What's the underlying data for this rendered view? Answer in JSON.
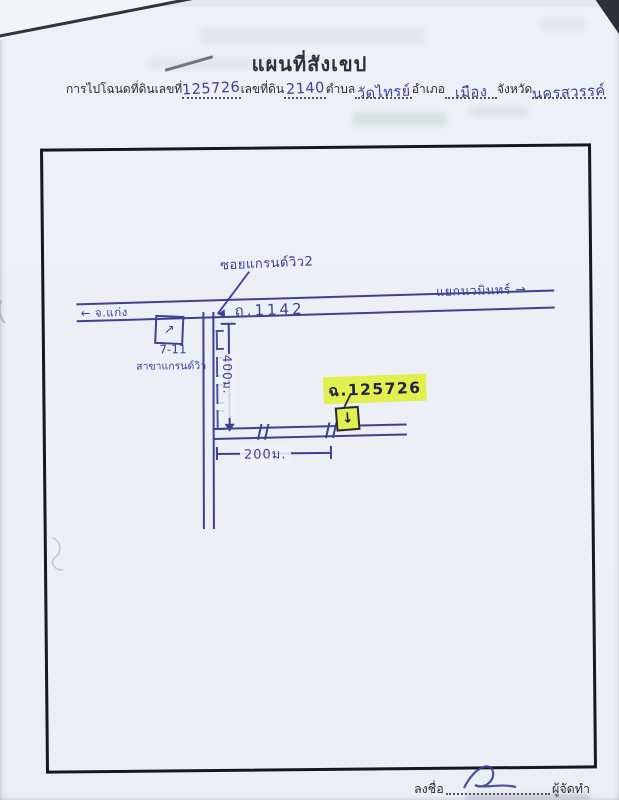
{
  "header": {
    "title": "แผนที่สังเขป",
    "form": {
      "deed_label": "การไปโฉนดที่ดินเลขที่",
      "deed_value": "125726",
      "parcel_label": "เลขที่ดิน",
      "parcel_value": "2140",
      "tambon_label": "ตำบล",
      "tambon_value": "วัดไทรย์",
      "amphoe_label": "อำเภอ",
      "amphoe_value": "เมือง",
      "province_label": "จังหวัด",
      "province_value": "นครสวรรค์"
    }
  },
  "map": {
    "main_road_label": "ถ.1142",
    "left_direction": "จ.แก่ง",
    "left_arrow": "←",
    "right_direction": "แยกนวมินทร์",
    "right_arrow": "→",
    "soi_label": "ซอยแกรนด์วิว2",
    "store_name": "7-11",
    "store_branch": "สาขาแกรนด์วิว",
    "store_arrow": "↗",
    "vertical_distance": "400ม.",
    "horizontal_distance": "200ม.",
    "parcel_tag": "ฉ.125726",
    "parcel_arrow": "↓"
  },
  "footer": {
    "sign_label": "ลงชื่อ",
    "maker_label": "ผู้จัดทำ"
  },
  "colors": {
    "pen_blue": "#3c4196",
    "ink_black": "#26262e",
    "highlight_yellow": "#e1ef4f",
    "frame_black": "#17171f"
  }
}
